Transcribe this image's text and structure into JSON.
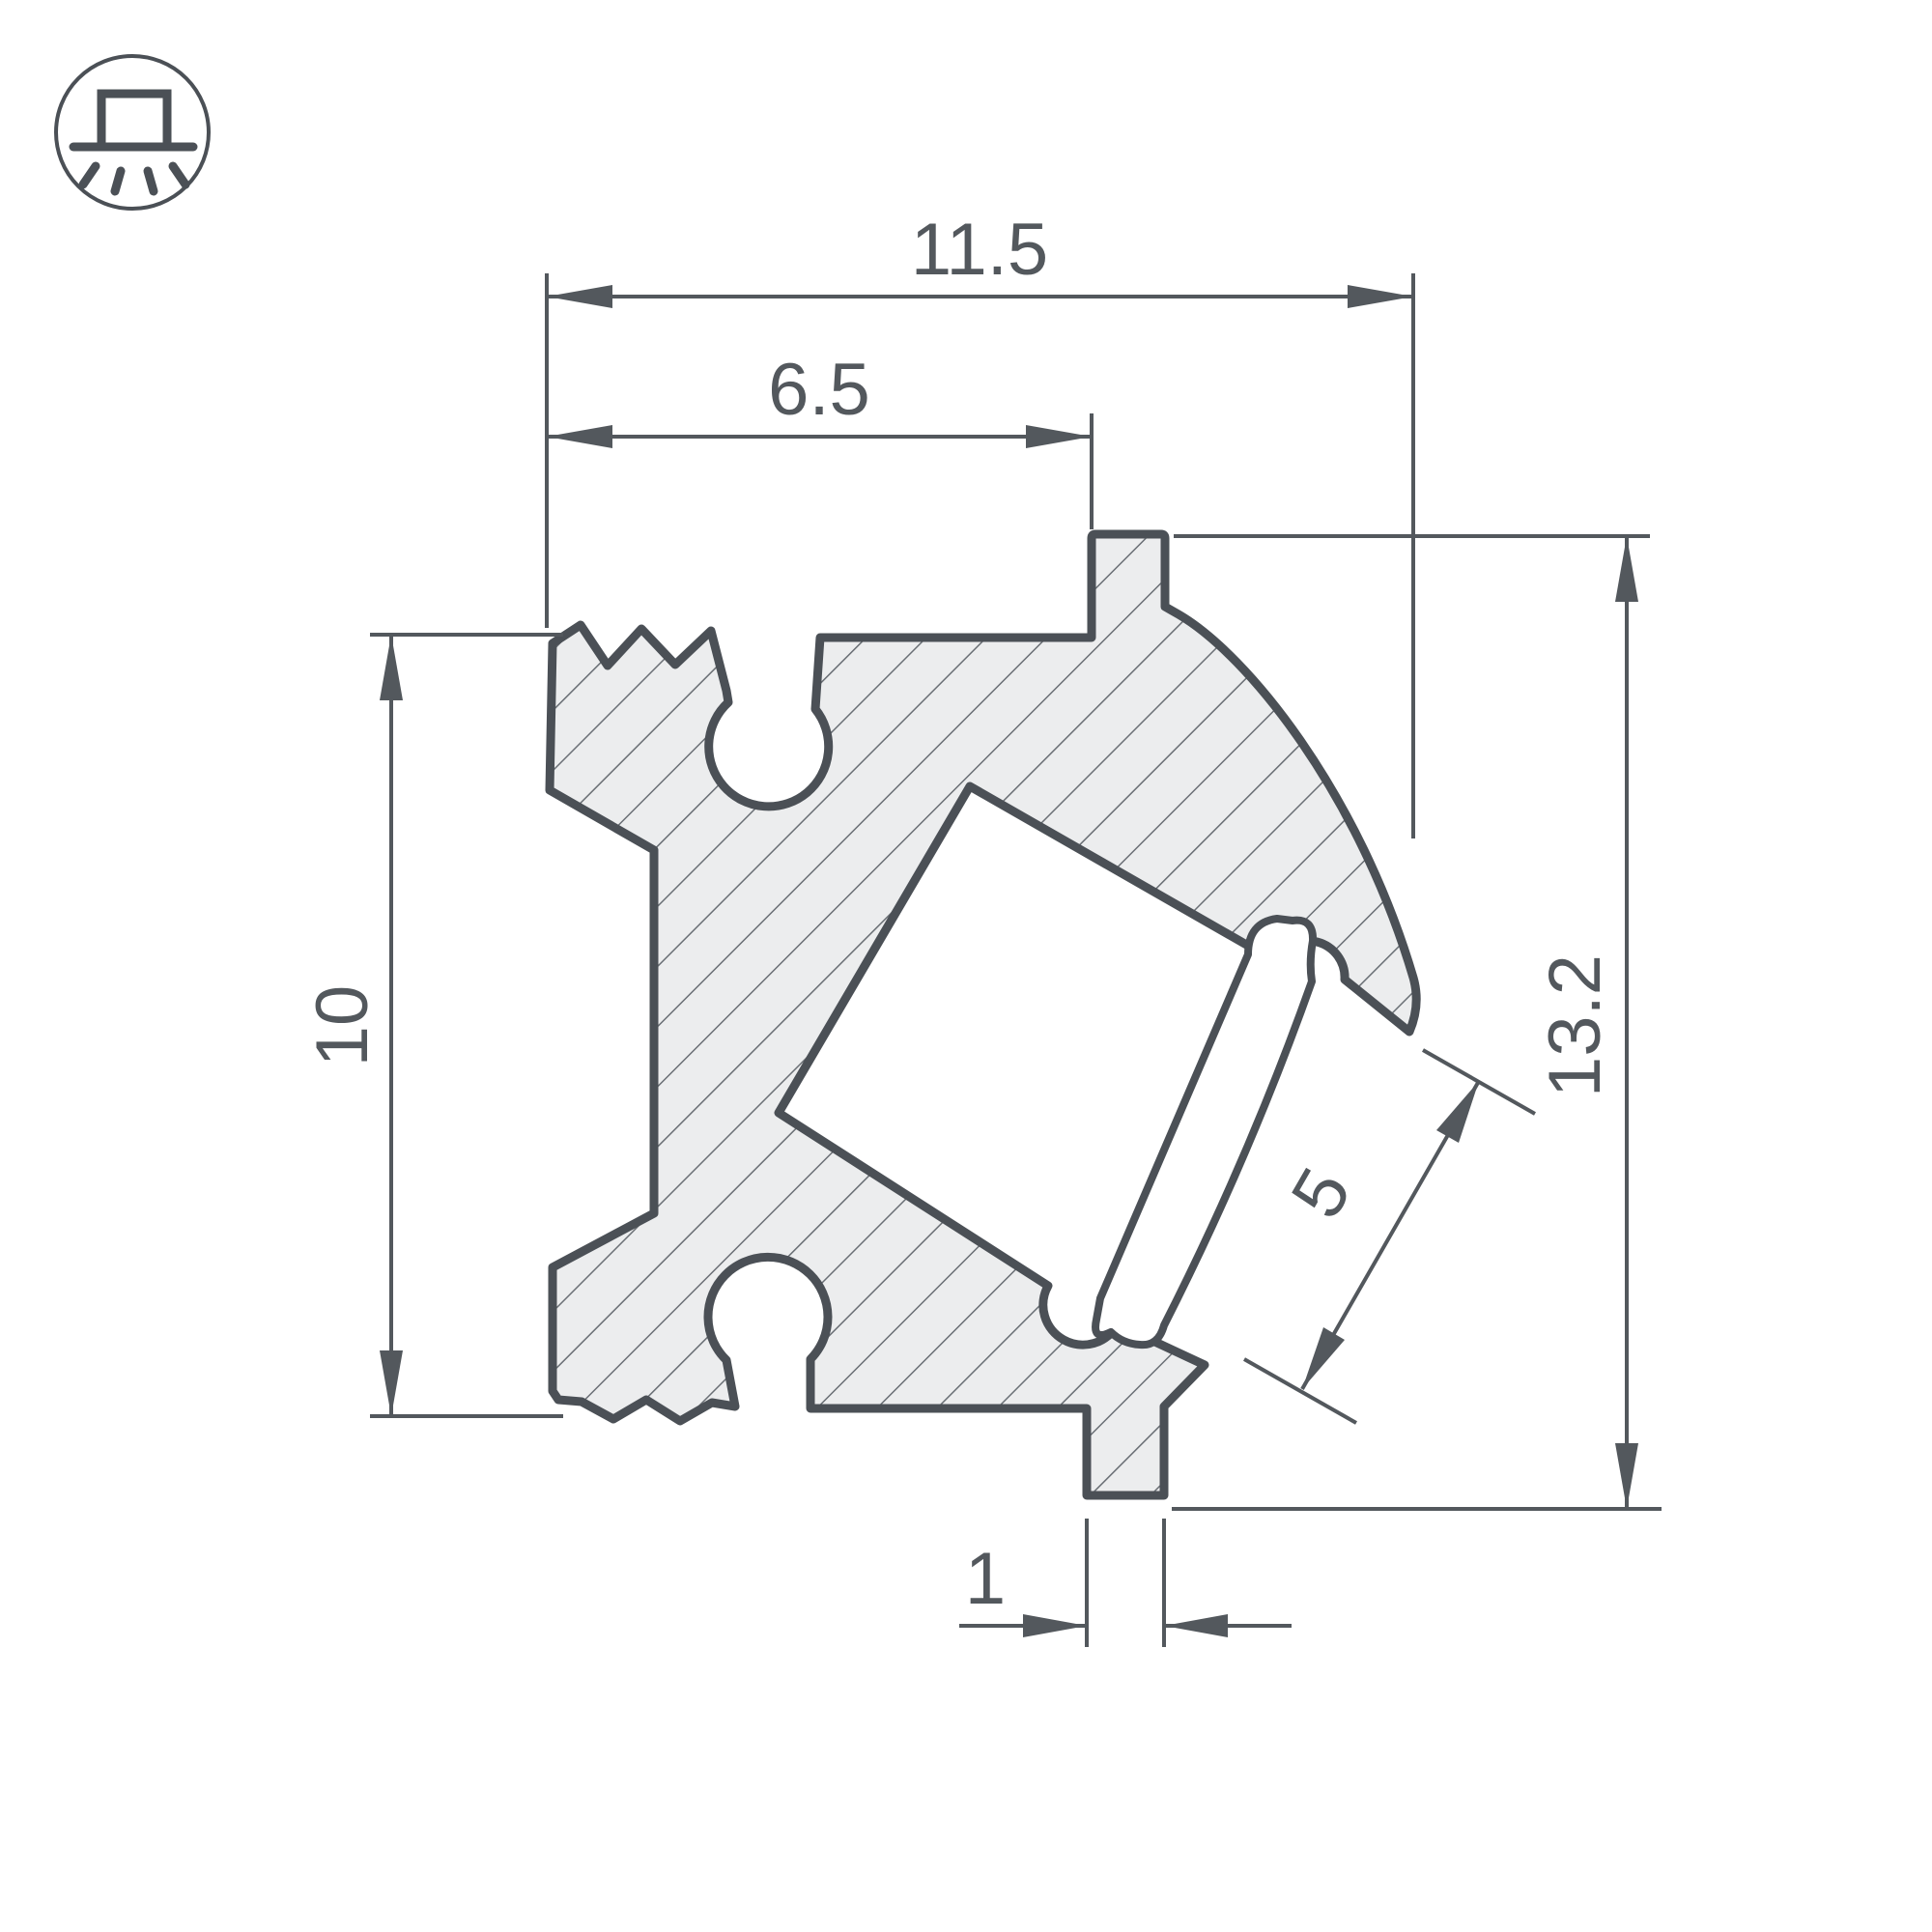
{
  "drawing": {
    "title": "LED profile cross-section technical drawing",
    "icon": {
      "name": "surface-mount-light-icon"
    },
    "colors": {
      "outline": "#4b5056",
      "body_fill": "#ecedee",
      "hatch_line": "#6a6f75",
      "dimension_line": "#53585d",
      "text": "#53585d",
      "background": "#ffffff"
    },
    "dimensions": {
      "top_width": "11.5",
      "inner_width": "6.5",
      "left_height": "10",
      "right_height": "13.2",
      "lens_width": "5",
      "foot_width": "1"
    }
  }
}
